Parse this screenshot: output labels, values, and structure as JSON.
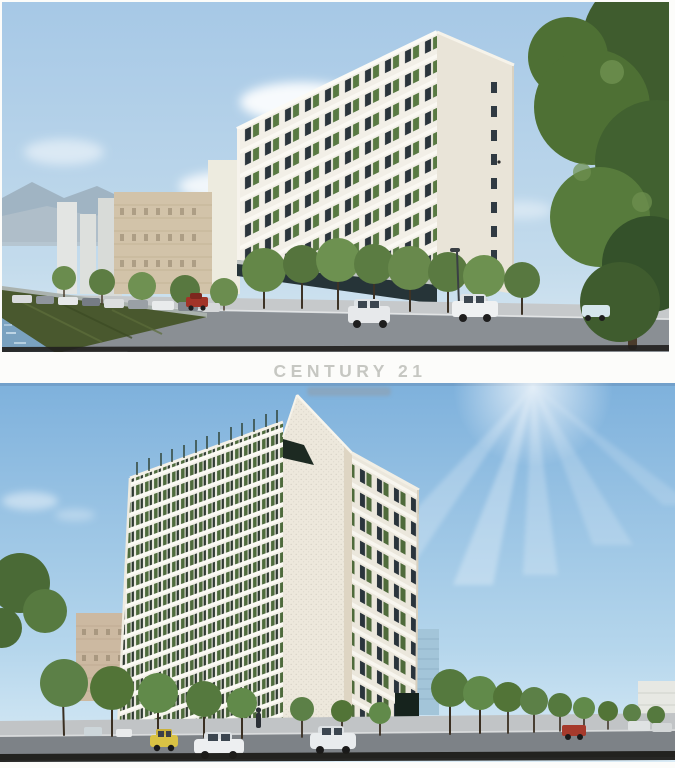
{
  "watermark": {
    "brand": "CENTURY 21",
    "subtext_visible": true
  },
  "photos": {
    "count": 2,
    "top": {
      "name": "street-view-rendering"
    },
    "bottom": {
      "name": "corner-view-rendering"
    }
  },
  "palette": {
    "page_bg": "#fcfcfa",
    "wm_color": "#c6c7c2",
    "sky_top_1": "#a6c8e6",
    "sky_bottom_1": "#d8e8f2",
    "sky_top_2": "#7eb1dc",
    "sky_bottom_2": "#d9ebf6",
    "facade_white": "#f1eee6",
    "balcony_green": "#567341",
    "window_dark": "#2b353c",
    "tree_green": "#5f8348",
    "road_gray": "#83888d",
    "water_blue": "#7aa2c0",
    "grass_green": "#49582e",
    "scan_edge": "#22211e"
  }
}
